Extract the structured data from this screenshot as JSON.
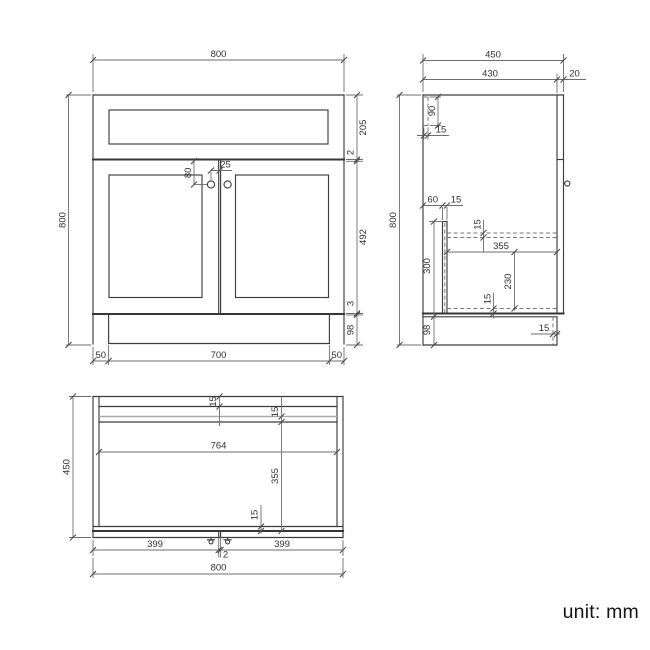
{
  "unit": {
    "label": "unit: mm"
  },
  "front": {
    "width": "800",
    "height": "800",
    "drawer_h": "205",
    "gap_top": "2",
    "door_h": "492",
    "gap_bottom": "3",
    "plinth_h": "98",
    "recess_l": "50",
    "plinth_w": "700",
    "recess_r": "50",
    "knob_drop": "80",
    "knob_offset": "25"
  },
  "side": {
    "depth_total": "450",
    "depth_carcass": "430",
    "door_t": "20",
    "height": "800",
    "mid_h": "300",
    "plinth_h": "98",
    "back_h": "90",
    "back_t": "15",
    "part_off": "60",
    "part_t": "15",
    "shelf_t": "15",
    "shelf_d": "355",
    "under_h": "230",
    "bottom_t": "15",
    "plinth_recess": "15"
  },
  "plan": {
    "depth": "450",
    "rail1_t": "15",
    "rail2_t": "15",
    "inner_w": "764",
    "inner_d": "355",
    "front_t": "15",
    "door_l": "399",
    "gap": "2",
    "door_r": "399",
    "width": "800"
  }
}
